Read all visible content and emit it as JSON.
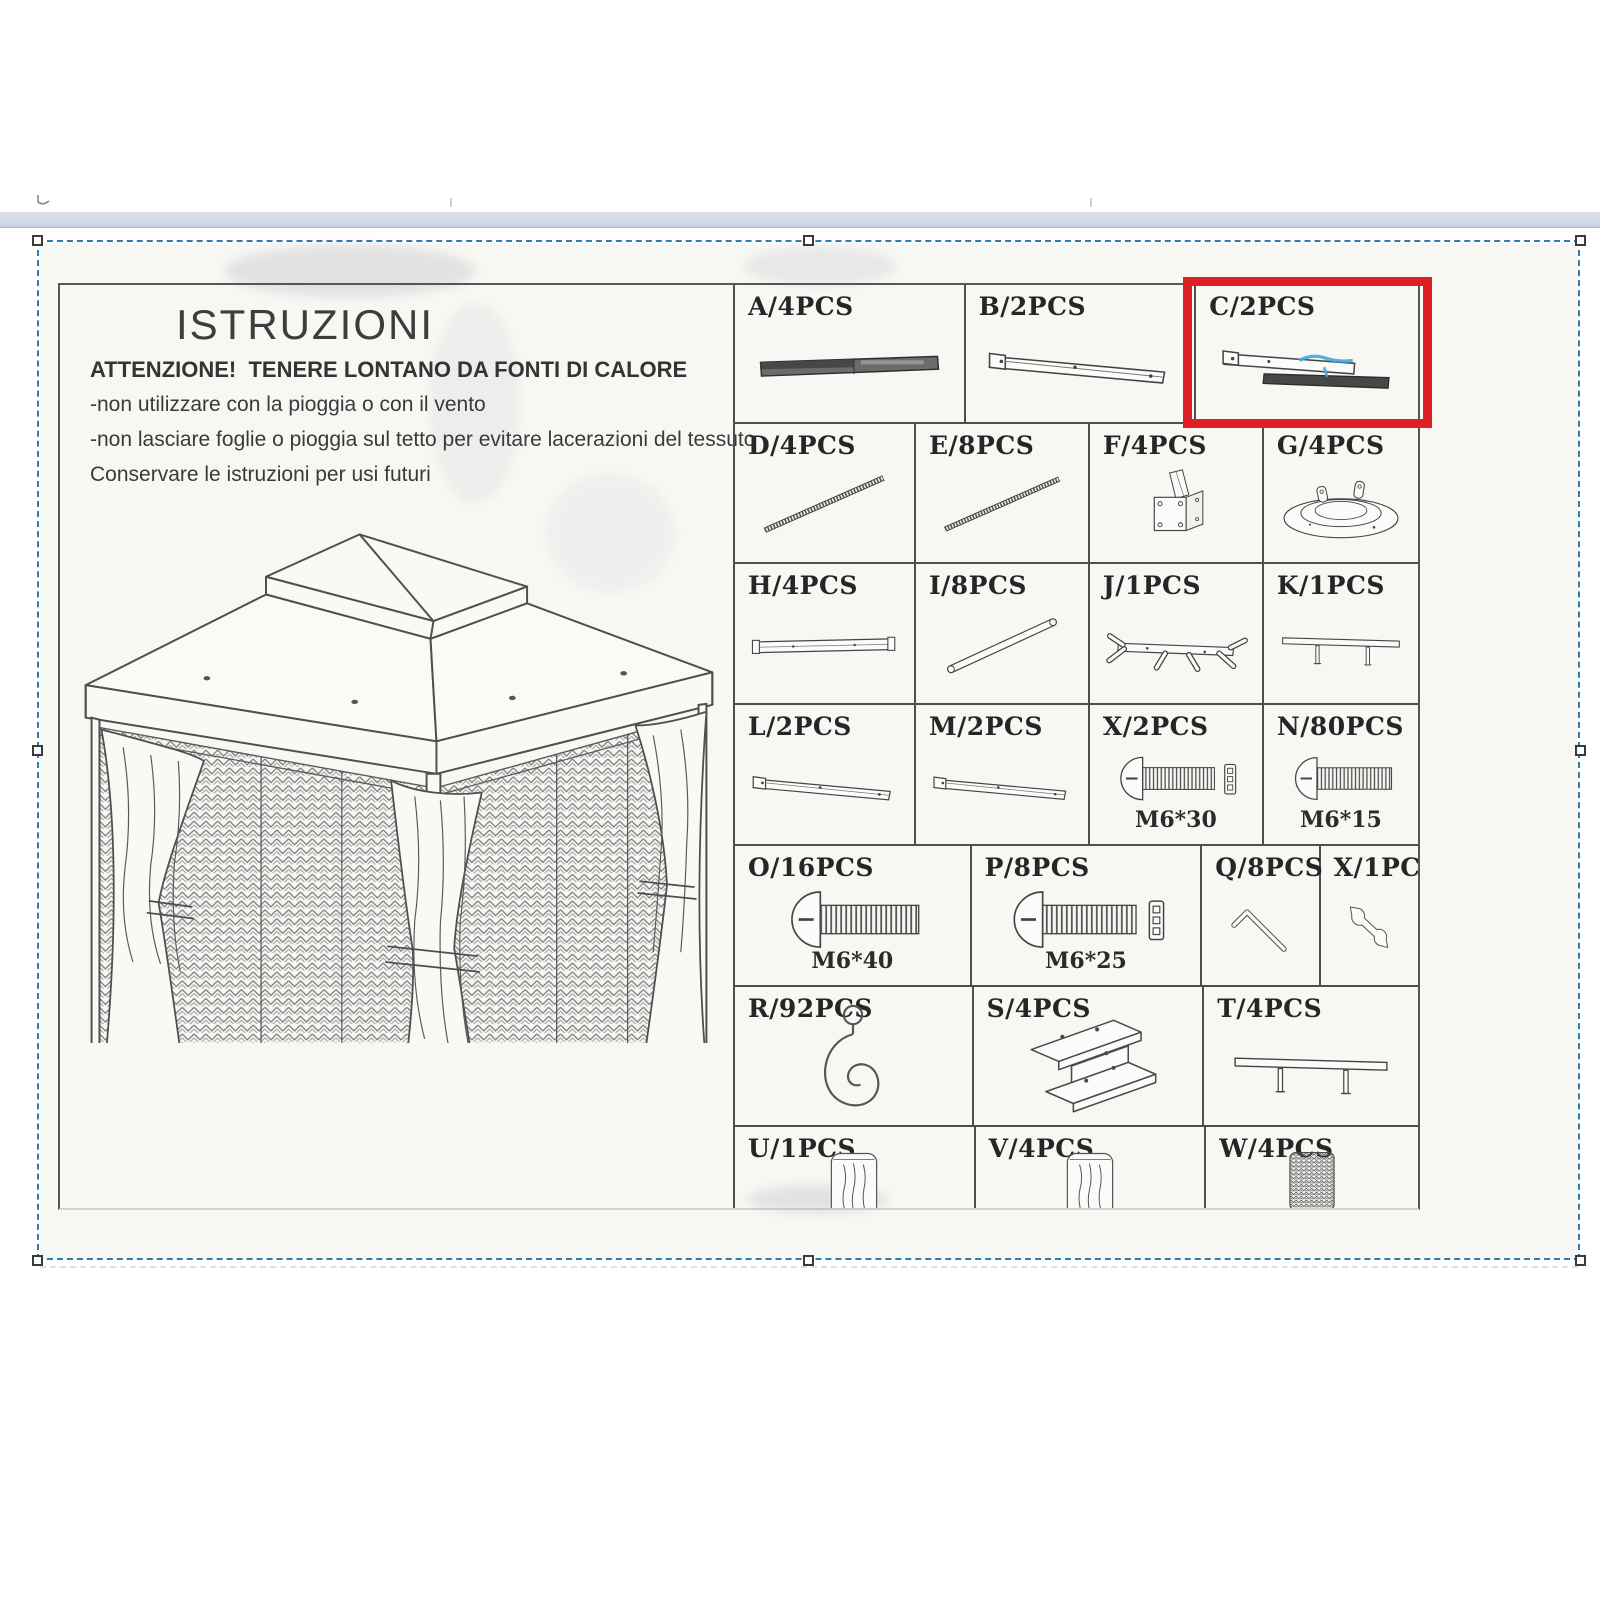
{
  "colors": {
    "highlight_red": "#df1f26",
    "selection_blue": "#2f7cab",
    "scan_ink": "#4e4e4e",
    "paper": "#f7f7f4",
    "pen_blue": "#3fa8dc"
  },
  "instructions": {
    "title": "ISTRUZIONI",
    "warning": "ATTENZIONE!  TENERE LONTANO DA FONTI DI CALORE",
    "lines": [
      "-non utilizzare con la pioggia o con il vento",
      "-non lasciare foglie o pioggia sul tetto per evitare lacerazioni del tessuto",
      "Conservare le istruzioni per usi futuri"
    ]
  },
  "drawing": {
    "subject": "gazebo-line-drawing"
  },
  "highlight": {
    "part": "C",
    "label": "C/2PCS"
  },
  "parts_grid": {
    "rows": [
      {
        "height": 137,
        "col_widths": [
          232,
          232,
          223
        ],
        "cells": [
          {
            "id": "A",
            "label": "A/4PCS",
            "icon": "bar-dark"
          },
          {
            "id": "B",
            "label": "B/2PCS",
            "icon": "bar-outline"
          },
          {
            "id": "C",
            "label": "C/2PCS",
            "icon": "bar-double-blue",
            "highlighted": true
          }
        ]
      },
      {
        "height": 138,
        "col_widths": [
          182,
          175,
          175,
          155
        ],
        "cells": [
          {
            "id": "D",
            "label": "D/4PCS",
            "icon": "rod-diagonal"
          },
          {
            "id": "E",
            "label": "E/8PCS",
            "icon": "rod-diagonal"
          },
          {
            "id": "F",
            "label": "F/4PCS",
            "icon": "corner-bracket"
          },
          {
            "id": "G",
            "label": "G/4PCS",
            "icon": "round-base"
          }
        ]
      },
      {
        "height": 139,
        "col_widths": [
          182,
          175,
          175,
          155
        ],
        "cells": [
          {
            "id": "H",
            "label": "H/4PCS",
            "icon": "bar-flat"
          },
          {
            "id": "I",
            "label": "I/8PCS",
            "icon": "tube-diagonal"
          },
          {
            "id": "J",
            "label": "J/1PCS",
            "icon": "hub-connector"
          },
          {
            "id": "K",
            "label": "K/1PCS",
            "icon": "bar-two-pegs"
          }
        ]
      },
      {
        "height": 139,
        "col_widths": [
          182,
          175,
          175,
          155
        ],
        "cells": [
          {
            "id": "L",
            "label": "L/2PCS",
            "icon": "bar-outline"
          },
          {
            "id": "M",
            "label": "M/2PCS",
            "icon": "bar-outline"
          },
          {
            "id": "X2",
            "label": "X/2PCS",
            "icon": "bolt-spacer",
            "size": "M6*30"
          },
          {
            "id": "N",
            "label": "N/80PCS",
            "icon": "bolt",
            "size": "M6*15"
          }
        ]
      },
      {
        "height": 139,
        "col_widths": [
          238,
          232,
          119,
          98
        ],
        "cells": [
          {
            "id": "O",
            "label": "O/16PCS",
            "icon": "bolt",
            "size": "M6*40"
          },
          {
            "id": "P",
            "label": "P/8PCS",
            "icon": "bolt-spacer",
            "size": "M6*25"
          },
          {
            "id": "Q",
            "label": "Q/8PCS",
            "icon": "allen-key"
          },
          {
            "id": "X1",
            "label": "X/1PCS",
            "icon": "wrench"
          }
        ]
      },
      {
        "height": 138,
        "col_widths": [
          240,
          232,
          215
        ],
        "cells": [
          {
            "id": "R",
            "label": "R/92PCS",
            "icon": "hook"
          },
          {
            "id": "S",
            "label": "S/4PCS",
            "icon": "i-beam"
          },
          {
            "id": "T",
            "label": "T/4PCS",
            "icon": "bar-two-pegs"
          }
        ]
      },
      {
        "height": 97,
        "col_widths": [
          242,
          232,
          213
        ],
        "cells": [
          {
            "id": "U",
            "label": "U/1PCS",
            "icon": "fabric-roll"
          },
          {
            "id": "V",
            "label": "V/4PCS",
            "icon": "fabric-roll"
          },
          {
            "id": "W",
            "label": "W/4PCS",
            "icon": "mesh-swatch"
          }
        ]
      }
    ]
  }
}
